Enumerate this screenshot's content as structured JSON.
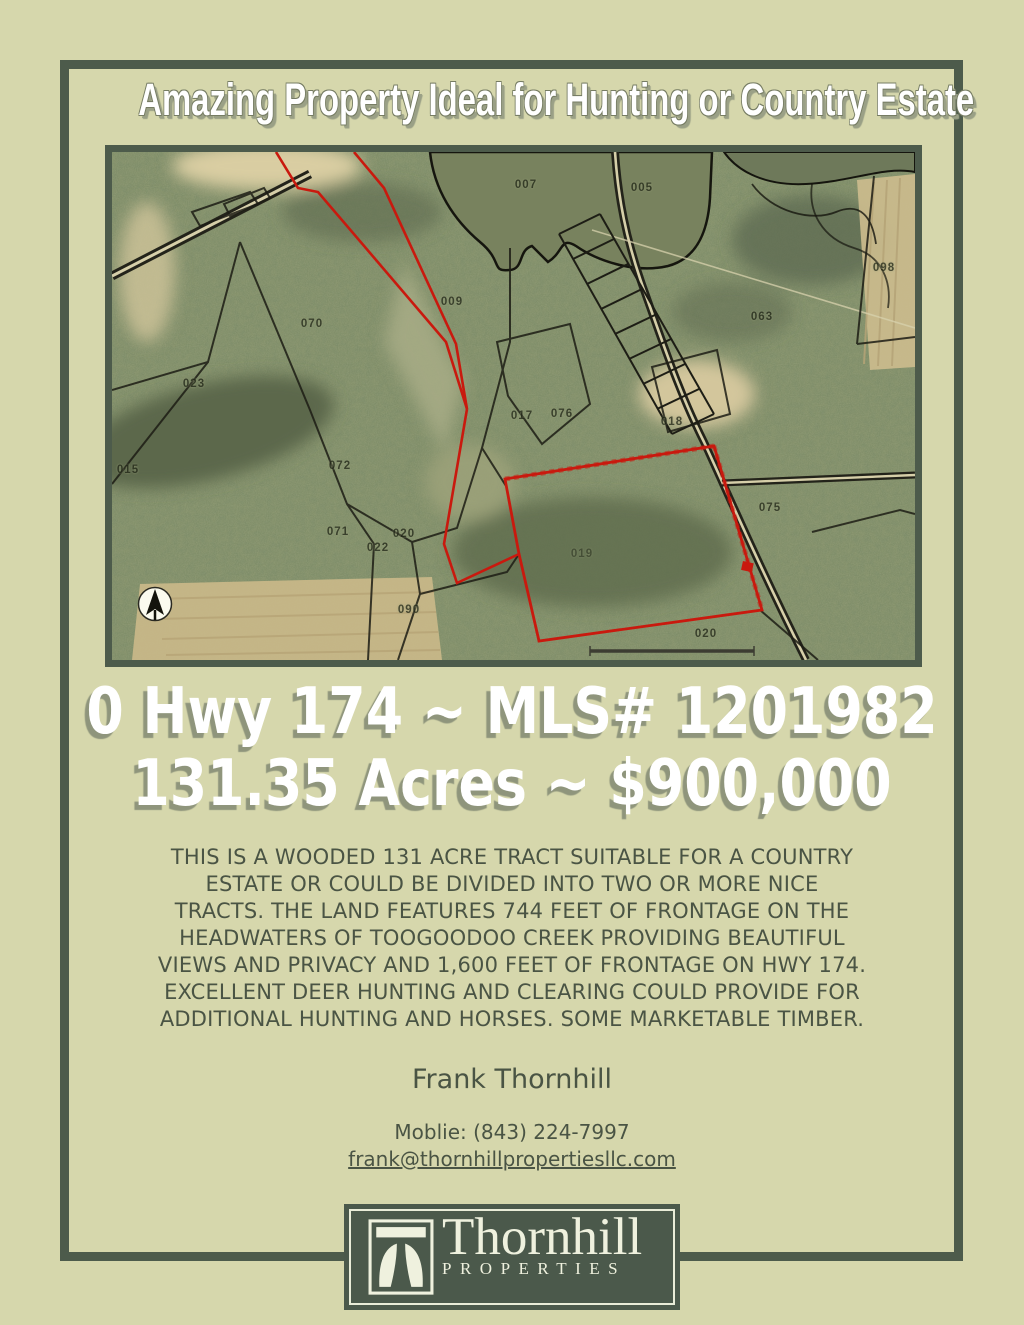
{
  "page": {
    "background_color": "#d6d7ac",
    "frame_color": "#4d5b4b",
    "accent_red": "#c9190e"
  },
  "header": {
    "title": "Amazing Property Ideal for Hunting or Country Estate"
  },
  "listing": {
    "address_line": "0 Hwy 174 ~ MLS# 1201982",
    "price_line": "131.35 Acres ~ $900,000",
    "description": "THIS IS A WOODED 131 ACRE TRACT SUITABLE FOR A COUNTRY\nESTATE OR COULD BE DIVIDED INTO TWO OR MORE NICE\nTRACTS. THE LAND FEATURES 744 FEET OF FRONTAGE ON THE\nHEADWATERS OF TOOGOODOO CREEK PROVIDING BEAUTIFUL\nVIEWS AND PRIVACY AND 1,600 FEET OF FRONTAGE ON HWY 174.\nEXCELLENT DEER HUNTING AND CLEARING COULD PROVIDE FOR\nADDITIONAL HUNTING AND HORSES. SOME MARKETABLE TIMBER."
  },
  "agent": {
    "name": "Frank Thornhill",
    "phone_label": "Moblie: (843) 224-7997",
    "email": "frank@thornhillpropertiesllc.com"
  },
  "logo": {
    "name": "Thornhill",
    "subtitle": "PROPERTIES"
  },
  "map": {
    "type": "aerial-parcel-map",
    "boundary_color": "#c9190e",
    "parcel_line_color": "#1d1d15",
    "has_north_arrow": true,
    "has_scale_bar": true,
    "parcel_labels": [
      {
        "text": "007",
        "x": 414,
        "y": 33
      },
      {
        "text": "005",
        "x": 530,
        "y": 36
      },
      {
        "text": "023",
        "x": 82,
        "y": 232
      },
      {
        "text": "070",
        "x": 200,
        "y": 172
      },
      {
        "text": "009",
        "x": 340,
        "y": 150
      },
      {
        "text": "063",
        "x": 650,
        "y": 165
      },
      {
        "text": "098",
        "x": 772,
        "y": 116
      },
      {
        "text": "015",
        "x": 16,
        "y": 318
      },
      {
        "text": "072",
        "x": 228,
        "y": 314
      },
      {
        "text": "071",
        "x": 226,
        "y": 380
      },
      {
        "text": "020",
        "x": 292,
        "y": 382
      },
      {
        "text": "022",
        "x": 266,
        "y": 396
      },
      {
        "text": "090",
        "x": 297,
        "y": 458
      },
      {
        "text": "075",
        "x": 658,
        "y": 356
      },
      {
        "text": "018",
        "x": 560,
        "y": 270
      },
      {
        "text": "017",
        "x": 410,
        "y": 264
      },
      {
        "text": "076",
        "x": 450,
        "y": 262
      },
      {
        "text": "019",
        "x": 470,
        "y": 402,
        "light": true
      },
      {
        "text": "020",
        "x": 594,
        "y": 482
      }
    ]
  }
}
